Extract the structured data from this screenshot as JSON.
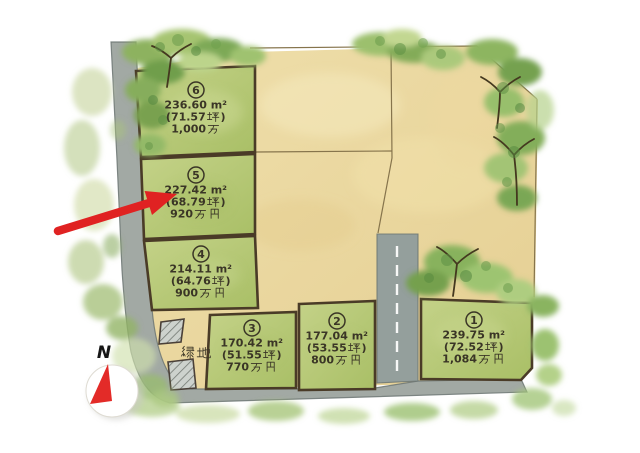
{
  "map": {
    "plots": [
      {
        "id": "1",
        "lines": [
          "239.75 ㎡",
          "(72.52 坪)",
          "1,084 万円"
        ]
      },
      {
        "id": "2",
        "lines": [
          "177.04 ㎡",
          "(53.55 坪)",
          "800 万円"
        ]
      },
      {
        "id": "3",
        "lines": [
          "170.42 ㎡",
          "(51.55 坪)",
          "770 万円"
        ]
      },
      {
        "id": "4",
        "lines": [
          "214.11 ㎡",
          "(64.76 坪)",
          "900 万円"
        ]
      },
      {
        "id": "5",
        "lines": [
          "227.42 ㎡",
          "(68.79 坪)",
          "920 万円"
        ]
      },
      {
        "id": "6",
        "lines": [
          "236.60 ㎡",
          "(71.57 坪)",
          "1,000 万"
        ]
      }
    ],
    "green_space_label": "緑地",
    "compass_label": "N",
    "highlighted_plot": "5"
  },
  "colors": {
    "plot_green": "#b5c671",
    "tan_parcel": "#ead79c",
    "road_grey": "#9aa3a1",
    "plot_border": "#4a3b27",
    "arrow_red": "#e02222",
    "compass_red": "#e32b28",
    "text": "#3a3526"
  }
}
